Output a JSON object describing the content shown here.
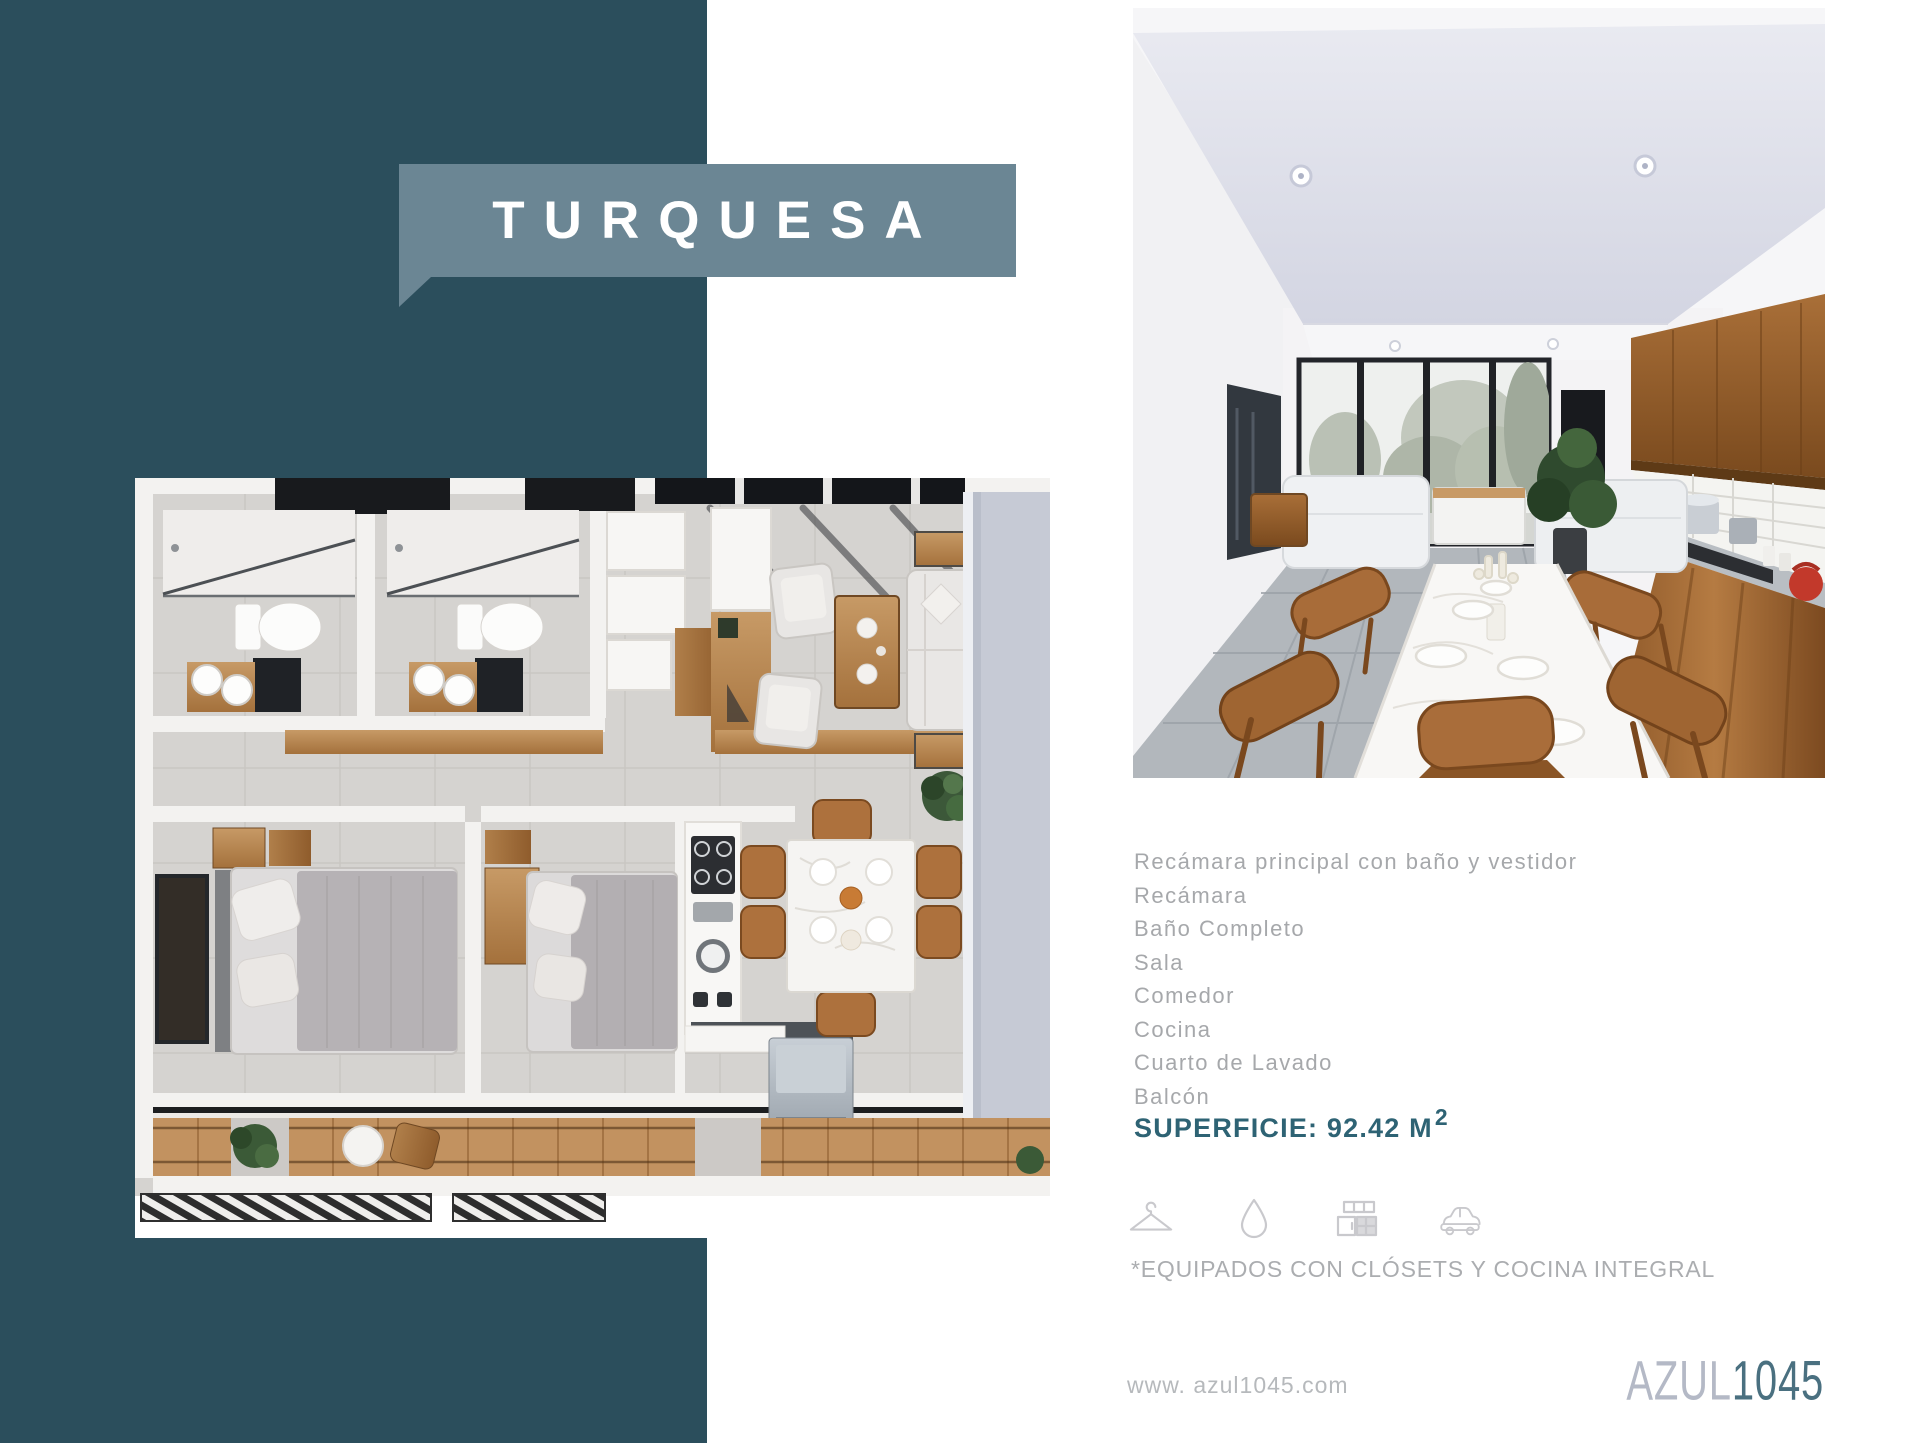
{
  "page": {
    "colors": {
      "band": "#2b4e5c",
      "banner": "#6b8694",
      "accent": "#2e6374"
    }
  },
  "banner": {
    "title": "TURQUESA"
  },
  "details": {
    "rooms": [
      "Recámara principal con baño y vestidor",
      "Recámara",
      "Baño Completo",
      "Sala",
      "Comedor",
      "Cocina",
      "Cuarto de Lavado",
      "Balcón"
    ],
    "superficie_label": "SUPERFICIE: 92.42 M",
    "superficie_exponent": "2"
  },
  "amenities": {
    "icons": [
      "hanger-icon",
      "water-drop-icon",
      "kitchen-icon",
      "car-icon"
    ],
    "note": "*EQUIPADOS CON CLÓSETS Y COCINA INTEGRAL"
  },
  "footer": {
    "website": "www. azul1045.com",
    "logo_part1": "AZUL",
    "logo_part2": "1045"
  }
}
